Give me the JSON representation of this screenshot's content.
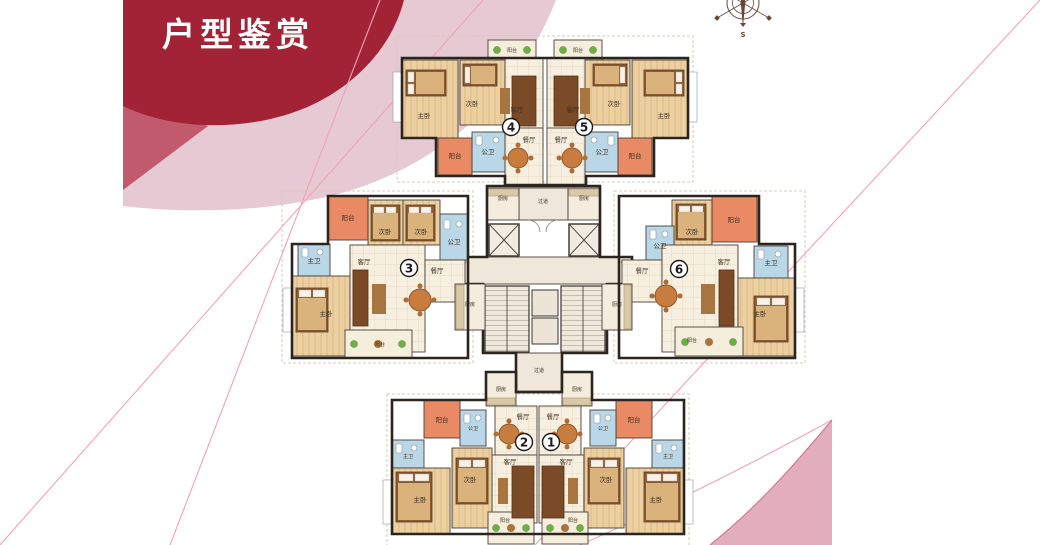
{
  "page": {
    "title": "户型鉴赏"
  },
  "compass": {
    "south_label": "S"
  },
  "colors": {
    "banner_red": "#a32336",
    "banner_mid_pink": "#c25a6e",
    "band_pink": "#e7c9d4",
    "line_pink": "#f0a3b5",
    "wedge_pink": "#e2aebd",
    "wedge_edge_pink": "#d5788f",
    "balcony_orange": "#e98a64",
    "bath_blue": "#b9d7e6",
    "wood_floor": "#ecd0a2",
    "tile_cream": "#f7f0e0",
    "wall_dark": "#2b241f",
    "garden_green": "#6fae45",
    "compass_brown": "#6a4636"
  },
  "floor_plan": {
    "room_labels": {
      "master_bedroom": "主卧",
      "second_bedroom": "次卧",
      "living_room": "客厅",
      "dining_room": "餐厅",
      "kitchen": "厨房",
      "bathroom": "公卫",
      "master_bathroom": "主卫",
      "balcony": "阳台",
      "corridor": "过道"
    },
    "units": [
      {
        "number": "1"
      },
      {
        "number": "2"
      },
      {
        "number": "3"
      },
      {
        "number": "4"
      },
      {
        "number": "5"
      },
      {
        "number": "6"
      }
    ]
  }
}
